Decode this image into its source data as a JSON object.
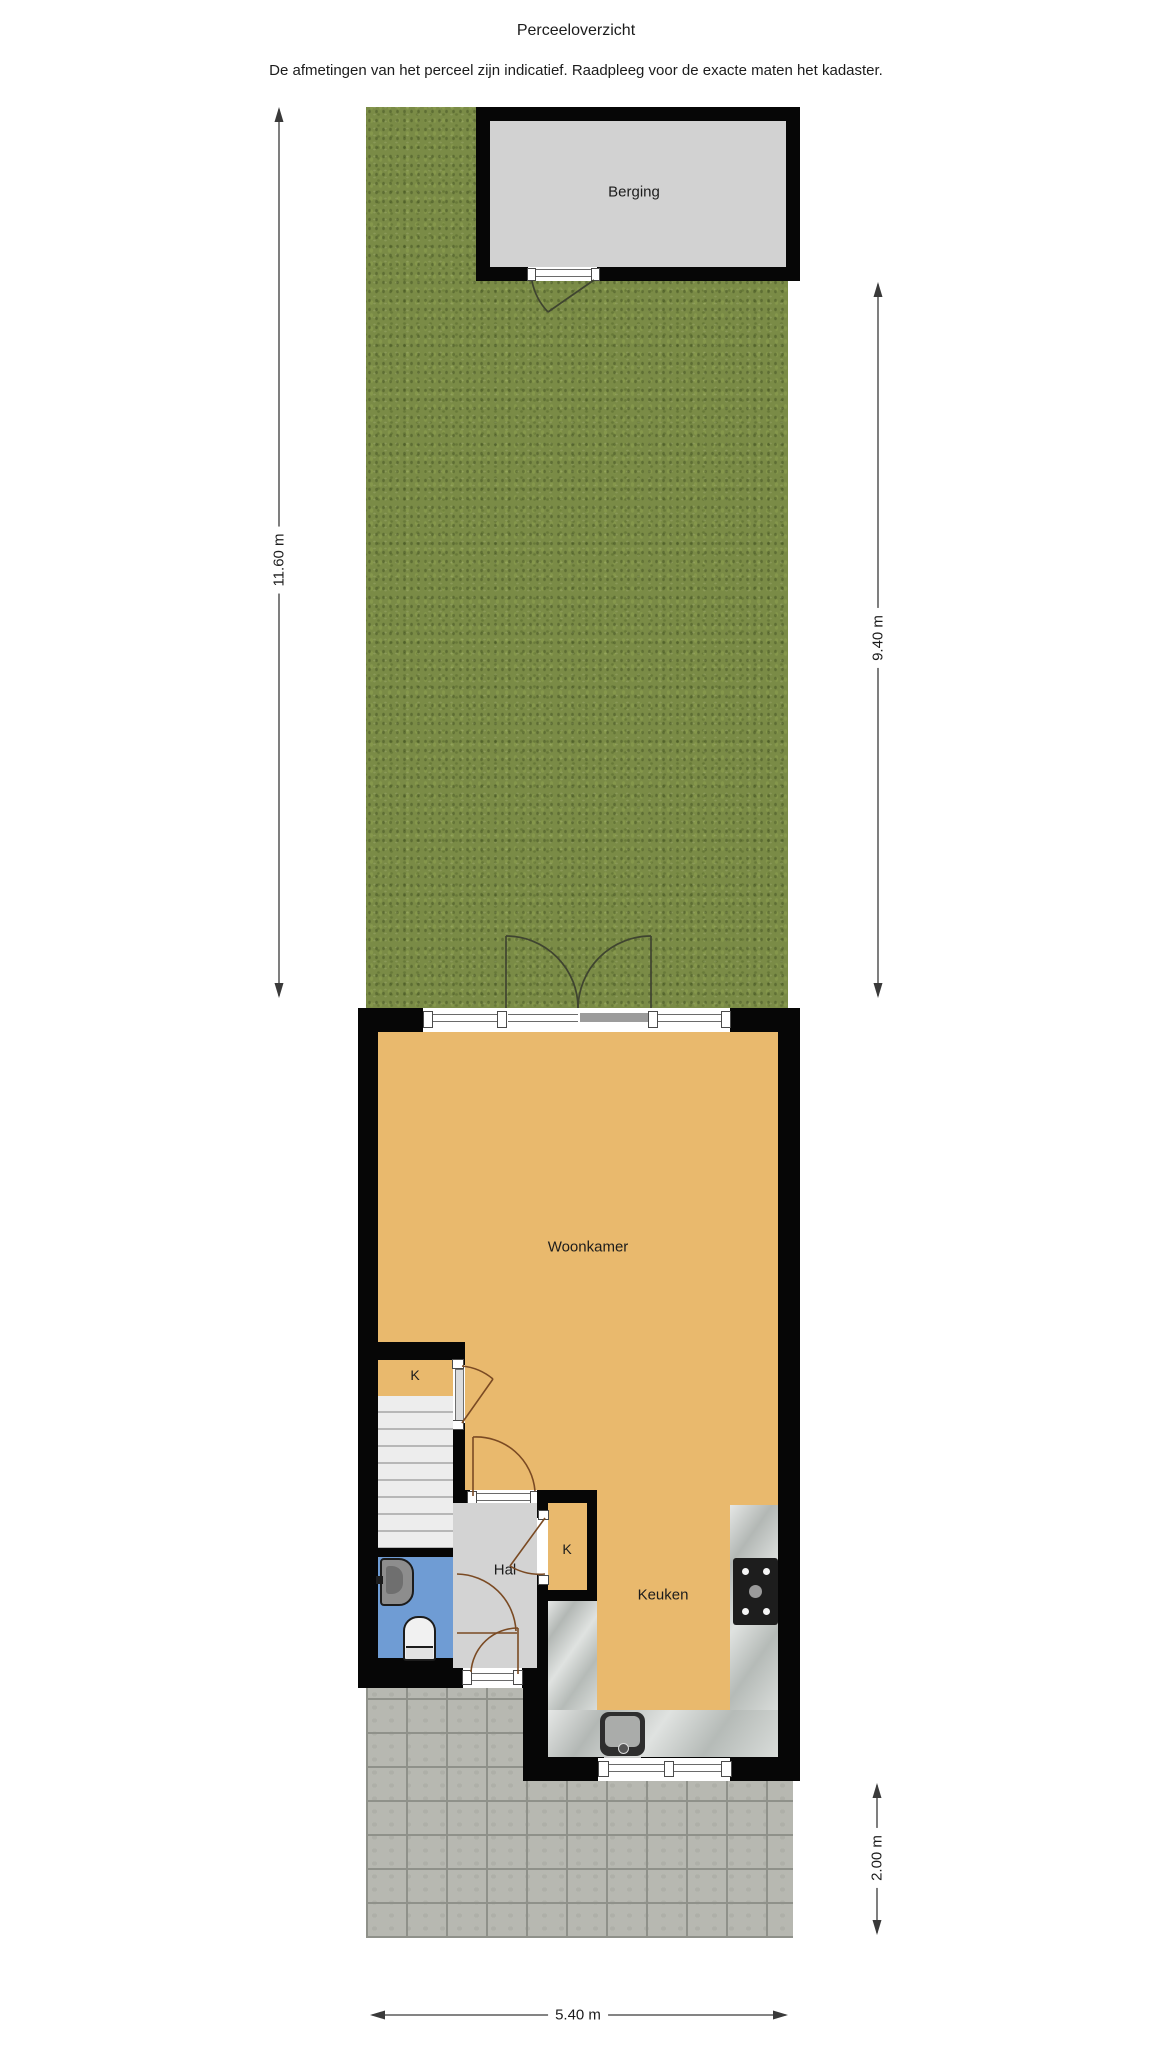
{
  "header": {
    "title": "Perceeloverzicht",
    "disclaimer": "De afmetingen van het perceel zijn indicatief. Raadpleeg voor de exacte maten het kadaster."
  },
  "rooms": {
    "berging": "Berging",
    "woonkamer": "Woonkamer",
    "keuken": "Keuken",
    "hal": "Hal",
    "kast1": "K",
    "kast2": "K"
  },
  "dimensions": {
    "garden_depth": "11.60 m",
    "garden_to_shed": "9.40 m",
    "terrace_depth": "2.00 m",
    "plot_width": "5.40 m"
  },
  "colors": {
    "grass": "#7a8b46",
    "wall": "#060606",
    "berging_floor": "#d2d2d2",
    "room_floor": "#e9b96d",
    "hal_floor": "#d3d3d3",
    "toilet_floor": "#6f9cd4",
    "counter": "#c6cac7",
    "paving": "#b7b8b1",
    "paving_joint": "#8f918a",
    "stairs": "#ededed",
    "stair_line": "#b7b7b7",
    "glazing_line": "#6a6a6a",
    "door_interior": "#7a4a23",
    "door_exterior": "#3f4430",
    "dim_line": "#3a3a3a",
    "text": "#1c1c1c",
    "stove": "#1d1d1d",
    "sink_outer": "#2e2e2e",
    "sink_inner": "#aaacaa",
    "fixture_gray": "#8d8d8d"
  }
}
